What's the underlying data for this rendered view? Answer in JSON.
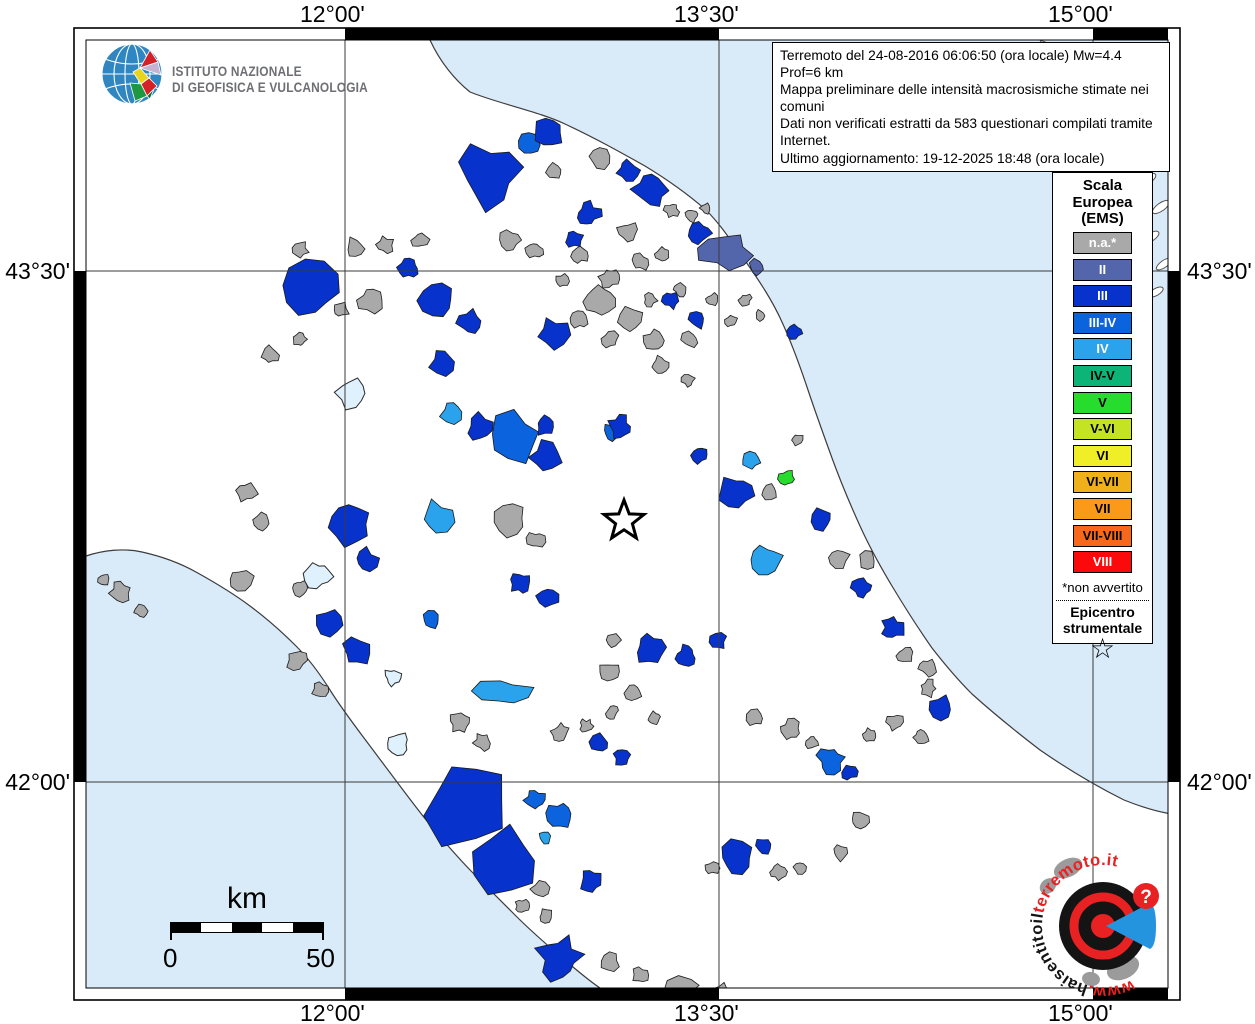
{
  "axis": {
    "top": [
      "12°00'",
      "13°30'",
      "15°00'"
    ],
    "bottom": [
      "12°00'",
      "13°30'",
      "15°00'"
    ],
    "left": [
      "43°30'",
      "42°00'"
    ],
    "right": [
      "43°30'",
      "42°00'"
    ]
  },
  "ingv": {
    "line1": "ISTITUTO NAZIONALE",
    "line2": "DI GEOFISICA E VULCANOLOGIA"
  },
  "info_box": {
    "lines": [
      "Terremoto del 24-08-2016 06:06:50 (ora locale) Mw=4.4 Prof=6 km",
      "Mappa preliminare delle intensità macrosismiche stimate nei comuni",
      "Dati non verificati estratti da 583 questionari compilati tramite Internet.",
      "Ultimo aggiornamento: 19-12-2025 18:48 (ora locale)"
    ]
  },
  "legend": {
    "title_lines": [
      "Scala",
      "Europea",
      "(EMS)"
    ],
    "entries": [
      {
        "label": "n.a.*",
        "color": "#a9a9a9",
        "text": "#ffffff"
      },
      {
        "label": "II",
        "color": "#5466ab",
        "text": "#ffffff"
      },
      {
        "label": "III",
        "color": "#0733cc",
        "text": "#ffffff"
      },
      {
        "label": "III-IV",
        "color": "#0b63dd",
        "text": "#ffffff"
      },
      {
        "label": "IV",
        "color": "#2aa3ec",
        "text": "#ffffff"
      },
      {
        "label": "IV-V",
        "color": "#0cb478",
        "text": "#000000"
      },
      {
        "label": "V",
        "color": "#26dd2e",
        "text": "#000000"
      },
      {
        "label": "V-VI",
        "color": "#c4e322",
        "text": "#000000"
      },
      {
        "label": "VI",
        "color": "#f0ee26",
        "text": "#000000"
      },
      {
        "label": "VI-VII",
        "color": "#f0b01c",
        "text": "#000000"
      },
      {
        "label": "VII",
        "color": "#fb9a18",
        "text": "#000000"
      },
      {
        "label": "VII-VIII",
        "color": "#f8681c",
        "text": "#000000"
      },
      {
        "label": "VIII",
        "color": "#fa0a0a",
        "text": "#ffffff"
      }
    ],
    "footnote": "*non avvertito",
    "epicenter_lines": [
      "Epicentro",
      "strumentale"
    ],
    "star_glyph": "☆"
  },
  "scale_bar": {
    "title": "km",
    "start_label": "0",
    "end_label": "50"
  },
  "watermark": {
    "text_www": "www.",
    "text_black": "haisentitoil",
    "text_red": "terremoto.it",
    "question_mark": "?"
  },
  "map": {
    "sea_color": "#d9eaf8",
    "land_color": "#ffffff",
    "lake_color": "#def1fc",
    "gridline_color": "#3a3a3a",
    "epicenter": {
      "x": 624,
      "y": 521
    },
    "lakes": [
      [
        352,
        393,
        17
      ],
      [
        318,
        575,
        15
      ],
      [
        393,
        677,
        9
      ],
      [
        398,
        744,
        12
      ]
    ],
    "municipalities": [
      [
        385,
        245,
        9,
        "n.a.*"
      ],
      [
        355,
        248,
        11,
        "n.a.*"
      ],
      [
        300,
        250,
        9,
        "n.a.*"
      ],
      [
        420,
        240,
        9,
        "n.a.*"
      ],
      [
        555,
        172,
        9,
        "n.a.*"
      ],
      [
        600,
        158,
        11,
        "n.a.*"
      ],
      [
        628,
        232,
        11,
        "n.a.*"
      ],
      [
        580,
        255,
        9,
        "n.a.*"
      ],
      [
        610,
        278,
        11,
        "n.a.*"
      ],
      [
        640,
        262,
        9,
        "n.a.*"
      ],
      [
        662,
        254,
        7,
        "n.a.*"
      ],
      [
        510,
        240,
        11,
        "n.a.*"
      ],
      [
        535,
        250,
        9,
        "n.a.*"
      ],
      [
        562,
        281,
        7,
        "n.a.*"
      ],
      [
        600,
        300,
        16,
        "n.a.*"
      ],
      [
        630,
        320,
        13,
        "n.a.*"
      ],
      [
        655,
        340,
        11,
        "n.a.*"
      ],
      [
        610,
        340,
        9,
        "n.a.*"
      ],
      [
        580,
        320,
        9,
        "n.a.*"
      ],
      [
        650,
        300,
        7,
        "n.a.*"
      ],
      [
        680,
        290,
        7,
        "n.a.*"
      ],
      [
        690,
        340,
        9,
        "n.a.*"
      ],
      [
        712,
        300,
        7,
        "n.a.*"
      ],
      [
        660,
        365,
        9,
        "n.a.*"
      ],
      [
        688,
        380,
        7,
        "n.a.*"
      ],
      [
        370,
        300,
        13,
        "n.a.*"
      ],
      [
        340,
        310,
        9,
        "n.a.*"
      ],
      [
        300,
        340,
        7,
        "n.a.*"
      ],
      [
        270,
        355,
        9,
        "n.a.*"
      ],
      [
        246,
        492,
        11,
        "n.a.*"
      ],
      [
        262,
        522,
        9,
        "n.a.*"
      ],
      [
        240,
        580,
        13,
        "n.a.*"
      ],
      [
        300,
        588,
        9,
        "n.a.*"
      ],
      [
        297,
        660,
        11,
        "n.a.*"
      ],
      [
        320,
        690,
        9,
        "n.a.*"
      ],
      [
        510,
        520,
        16,
        "n.a.*"
      ],
      [
        536,
        540,
        9,
        "n.a.*"
      ],
      [
        610,
        672,
        11,
        "n.a.*"
      ],
      [
        633,
        692,
        9,
        "n.a.*"
      ],
      [
        655,
        718,
        7,
        "n.a.*"
      ],
      [
        614,
        640,
        7,
        "n.a.*"
      ],
      [
        770,
        492,
        9,
        "n.a.*"
      ],
      [
        797,
        440,
        7,
        "n.a.*"
      ],
      [
        838,
        558,
        11,
        "n.a.*"
      ],
      [
        868,
        560,
        9,
        "n.a.*"
      ],
      [
        905,
        655,
        9,
        "n.a.*"
      ],
      [
        928,
        688,
        9,
        "n.a.*"
      ],
      [
        921,
        737,
        8,
        "n.a.*"
      ],
      [
        928,
        668,
        9,
        "n.a.*"
      ],
      [
        895,
        722,
        9,
        "n.a.*"
      ],
      [
        870,
        735,
        7,
        "n.a.*"
      ],
      [
        755,
        718,
        9,
        "n.a.*"
      ],
      [
        790,
        730,
        11,
        "n.a.*"
      ],
      [
        812,
        742,
        7,
        "n.a.*"
      ],
      [
        860,
        820,
        9,
        "n.a.*"
      ],
      [
        840,
        852,
        9,
        "n.a.*"
      ],
      [
        800,
        868,
        7,
        "n.a.*"
      ],
      [
        778,
        872,
        9,
        "n.a.*"
      ],
      [
        712,
        868,
        7,
        "n.a.*"
      ],
      [
        460,
        722,
        11,
        "n.a.*"
      ],
      [
        482,
        742,
        9,
        "n.a.*"
      ],
      [
        560,
        732,
        9,
        "n.a.*"
      ],
      [
        586,
        726,
        7,
        "n.a.*"
      ],
      [
        612,
        712,
        7,
        "n.a.*"
      ],
      [
        500,
        855,
        11,
        "n.a.*"
      ],
      [
        520,
        872,
        9,
        "n.a.*"
      ],
      [
        540,
        890,
        9,
        "n.a.*"
      ],
      [
        522,
        906,
        7,
        "n.a.*"
      ],
      [
        546,
        916,
        7,
        "n.a.*"
      ],
      [
        610,
        962,
        11,
        "n.a.*"
      ],
      [
        641,
        975,
        9,
        "n.a.*"
      ],
      [
        680,
        988,
        12,
        "n.a.*",
        1.8
      ],
      [
        722,
        992,
        9,
        "n.a.*"
      ],
      [
        120,
        592,
        11,
        "n.a.*"
      ],
      [
        141,
        610,
        7,
        "n.a.*"
      ],
      [
        104,
        580,
        7,
        "n.a.*"
      ],
      [
        672,
        210,
        8,
        "n.a.*"
      ],
      [
        692,
        215,
        7,
        "n.a.*"
      ],
      [
        706,
        208,
        6,
        "n.a.*"
      ],
      [
        745,
        300,
        7,
        "n.a.*"
      ],
      [
        760,
        315,
        6,
        "n.a.*"
      ],
      [
        731,
        321,
        7,
        "n.a.*"
      ],
      [
        726,
        252,
        20,
        "II",
        1.5
      ],
      [
        757,
        268,
        9,
        "II"
      ],
      [
        530,
        143,
        11,
        "III-IV"
      ],
      [
        515,
        437,
        26,
        "III-IV"
      ],
      [
        613,
        432,
        10,
        "III-IV"
      ],
      [
        560,
        815,
        13,
        "III-IV"
      ],
      [
        535,
        800,
        11,
        "III-IV"
      ],
      [
        831,
        760,
        14,
        "III-IV"
      ],
      [
        432,
        620,
        9,
        "III-IV"
      ],
      [
        751,
        461,
        9,
        "IV"
      ],
      [
        766,
        560,
        16,
        "IV"
      ],
      [
        437,
        518,
        18,
        "IV"
      ],
      [
        452,
        412,
        12,
        "IV"
      ],
      [
        503,
        692,
        14,
        "IV",
        2.0
      ],
      [
        545,
        838,
        7,
        "IV"
      ],
      [
        489,
        175,
        34,
        "III"
      ],
      [
        549,
        132,
        15,
        "III"
      ],
      [
        628,
        170,
        12,
        "III"
      ],
      [
        588,
        214,
        13,
        "III"
      ],
      [
        651,
        190,
        20,
        "III"
      ],
      [
        700,
        233,
        11,
        "III"
      ],
      [
        574,
        239,
        9,
        "III"
      ],
      [
        311,
        289,
        28,
        "III"
      ],
      [
        409,
        268,
        11,
        "III"
      ],
      [
        437,
        300,
        18,
        "III"
      ],
      [
        470,
        322,
        14,
        "III"
      ],
      [
        553,
        333,
        16,
        "III"
      ],
      [
        671,
        300,
        9,
        "III"
      ],
      [
        697,
        320,
        9,
        "III"
      ],
      [
        795,
        332,
        8,
        "III"
      ],
      [
        443,
        362,
        14,
        "III"
      ],
      [
        620,
        427,
        12,
        "III"
      ],
      [
        545,
        457,
        16,
        "III"
      ],
      [
        480,
        428,
        15,
        "III"
      ],
      [
        545,
        425,
        11,
        "III"
      ],
      [
        350,
        523,
        24,
        "III"
      ],
      [
        366,
        560,
        12,
        "III"
      ],
      [
        700,
        455,
        9,
        "III"
      ],
      [
        737,
        492,
        18,
        "III"
      ],
      [
        822,
        519,
        11,
        "III"
      ],
      [
        862,
        588,
        11,
        "III"
      ],
      [
        893,
        628,
        12,
        "III"
      ],
      [
        941,
        708,
        13,
        "III"
      ],
      [
        330,
        623,
        14,
        "III"
      ],
      [
        357,
        652,
        16,
        "III"
      ],
      [
        521,
        583,
        11,
        "III"
      ],
      [
        548,
        597,
        11,
        "III"
      ],
      [
        650,
        648,
        16,
        "III"
      ],
      [
        686,
        656,
        11,
        "III"
      ],
      [
        718,
        641,
        9,
        "III"
      ],
      [
        470,
        800,
        52,
        "III"
      ],
      [
        505,
        862,
        38,
        "III"
      ],
      [
        560,
        958,
        24,
        "III"
      ],
      [
        600,
        744,
        11,
        "III"
      ],
      [
        622,
        757,
        9,
        "III"
      ],
      [
        591,
        881,
        12,
        "III"
      ],
      [
        737,
        858,
        18,
        "III"
      ],
      [
        764,
        846,
        9,
        "III"
      ],
      [
        849,
        772,
        9,
        "III"
      ],
      [
        787,
        478,
        9,
        "V"
      ]
    ]
  }
}
